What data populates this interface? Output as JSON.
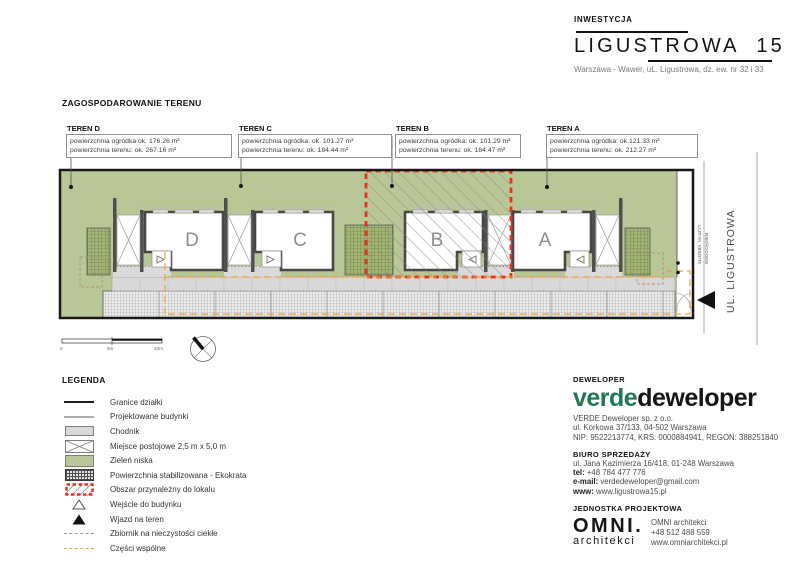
{
  "header": {
    "label": "INWESTYCJA",
    "title": "LIGUSTROWA 15",
    "subtitle": "Warszawa - Wawer, uL. Ligustrowa, dz. ew. nr 32 i 33"
  },
  "plan": {
    "section_title": "ZAGOSPODAROWANIE TERENU",
    "terrains": [
      {
        "name": "TEREN D",
        "line1": "powierzchnia ogródka ok. 176.26 m²",
        "line2": "powierzchnia terenu: ok. 267.16 m²"
      },
      {
        "name": "TEREN C",
        "line1": "powierzchnia ogródka: ok. 101.27 m²",
        "line2": "powierzchnia terenu: ok. 184.44 m²"
      },
      {
        "name": "TEREN B",
        "line1": "powierzchnia ogródka: ok. 101.29 m²",
        "line2": "powierzchnia terenu: ok. 184.47 m²"
      },
      {
        "name": "TEREN A",
        "line1": "powierzchnia ogródka: ok.121.33 m²",
        "line2": "powierzchnia terenu: ok. 212.27 m²"
      }
    ],
    "buildings": [
      "D",
      "C",
      "B",
      "A"
    ],
    "street_label": "UL. LIGUSTROWA",
    "easement_note_line1": "SŁUŻEBN. NA UŻYT.",
    "easement_note_line2": "WODOCIĄGIEM",
    "scale": {
      "zero": "0",
      "five": "5m",
      "ten": "10m"
    }
  },
  "legend": {
    "title": "LEGENDA",
    "items": [
      {
        "label": "Granice działki"
      },
      {
        "label": "Projektowane budynki"
      },
      {
        "label": "Chodnik"
      },
      {
        "label": "Miejsce postojowe 2,5 m x 5,0 m"
      },
      {
        "label": "Zieleń niska"
      },
      {
        "label": "Powierzchnia stabilizowana - Ekokrata"
      },
      {
        "label": "Obszar przynależny do lokalu"
      },
      {
        "label": "Wejście do budynku"
      },
      {
        "label": "Wjazd na teren"
      },
      {
        "label": "Zbiornik na nieczystości ciekłe"
      },
      {
        "label": "Części wspólne"
      }
    ]
  },
  "developer": {
    "section_label": "DEWELOPER",
    "logo_green": "verde",
    "logo_black": "deweloper",
    "company": "VERDE Deweloper sp. z o.o.",
    "address": "ul. Korkowa 37/133, 04-502 Warszawa",
    "registry": "NIP: 9522213774, KRS: 0000884941, REGON: 388251840",
    "sales_office": {
      "title": "BIURO SPRZEDAŻY",
      "address": "ul. Jana Kazimierza 16/418, 01-248 Warszawa",
      "tel_label": "tel:",
      "tel": "+48 784 477 776",
      "email_label": "e-mail:",
      "email": "verdedeweloper@gmail.com",
      "www_label": "www:",
      "www": "www.ligustrowa15.pl"
    }
  },
  "design_unit": {
    "section_label": "JEDNOSTKA PROJEKTOWA",
    "logo_line1": "OMNI.",
    "logo_line2": "architekci",
    "name": "OMNI architekci",
    "phone": "+48 512 488 559",
    "www": "www.omniarchitekci.pl"
  },
  "colors": {
    "verde_green": "#1e7a4e",
    "site_green": "#b9c797",
    "accent_red": "#e8301c",
    "accent_orange": "#e8a33d"
  }
}
